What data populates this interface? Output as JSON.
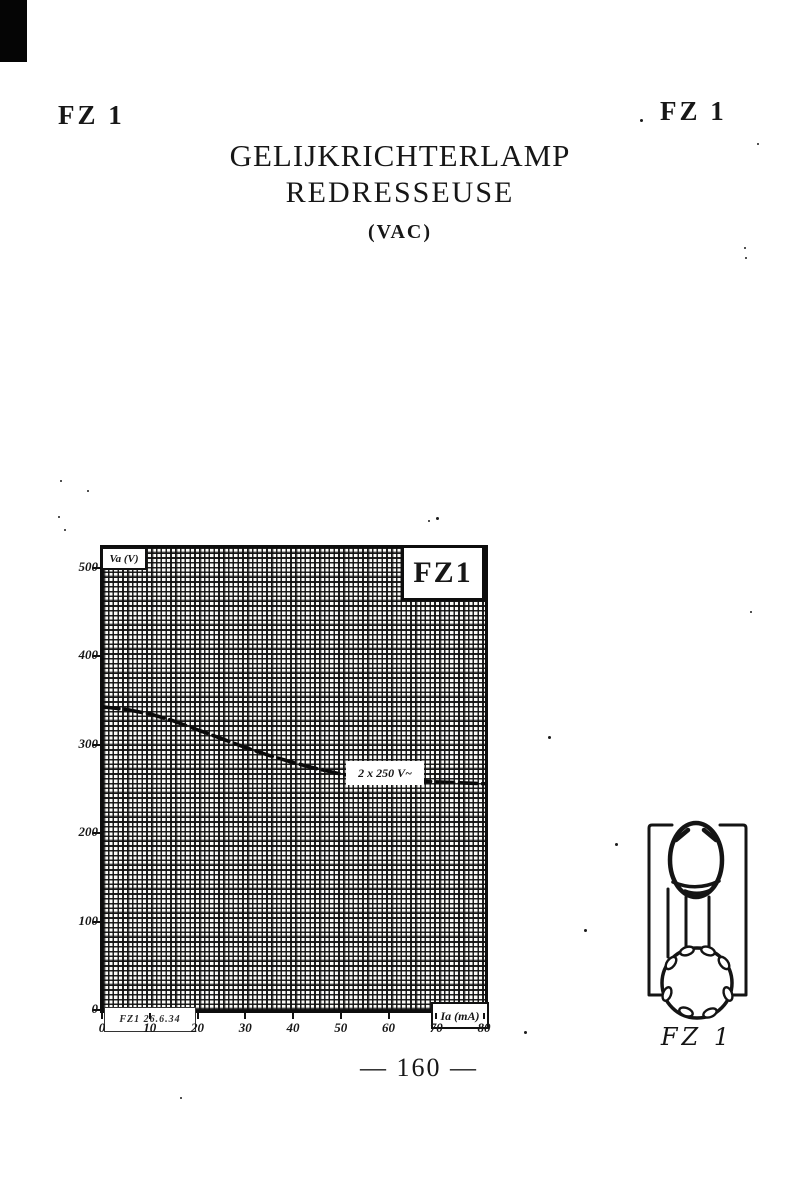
{
  "header": {
    "left_badge": "FZ 1",
    "right_badge": "FZ 1"
  },
  "title": {
    "line1": "GELIJKRICHTERLAMP",
    "line2": "REDRESSEUSE",
    "line3": "(VAC)"
  },
  "specs": {
    "rows": [
      {
        "param": "Vf",
        "eq": "=",
        "value": "13",
        "unit": "V."
      },
      {
        "param": "If",
        "eq": "=",
        "value": "0,25",
        "unit": "A."
      },
      {
        "param": "Va",
        "eq": "=",
        "value": "2 × 250",
        "unit": "V."
      },
      {
        "param": "Ia",
        "eq": "=",
        "value": "50",
        "unit": "mA."
      },
      {
        "param": "D",
        "eq": "=",
        "value": "37",
        "unit": "m/m"
      },
      {
        "param": "L",
        "eq": "=",
        "value": "91",
        "unit": "m/m"
      }
    ]
  },
  "chart_data": {
    "type": "line",
    "title": "FZ1",
    "ylabel": "Va (V)",
    "xlabel": "Ia (mA)",
    "annotation": "2 x 250 V~",
    "stamp": "FZ1 26.6.34",
    "xlim": [
      0,
      80
    ],
    "ylim": [
      0,
      500
    ],
    "x_ticks": [
      0,
      10,
      20,
      30,
      40,
      50,
      60,
      70,
      80
    ],
    "y_ticks": [
      0,
      100,
      200,
      300,
      400,
      500
    ],
    "grid": "fine-crosshatch",
    "legend_position": "none",
    "series": [
      {
        "name": "Va vs Ia at 2 x 250 V~",
        "x": [
          0,
          5,
          10,
          15,
          20,
          25,
          30,
          35,
          40,
          45,
          50,
          55,
          60,
          70,
          80
        ],
        "y": [
          343,
          340,
          335,
          327,
          317,
          307,
          297,
          288,
          280,
          273,
          267,
          263,
          261,
          258,
          256
        ]
      }
    ]
  },
  "pinout": {
    "caption": "FZ 1"
  },
  "footer": {
    "page_number": "— 160 —"
  },
  "colors": {
    "ink": "#171717",
    "paper": "#ffffff"
  }
}
